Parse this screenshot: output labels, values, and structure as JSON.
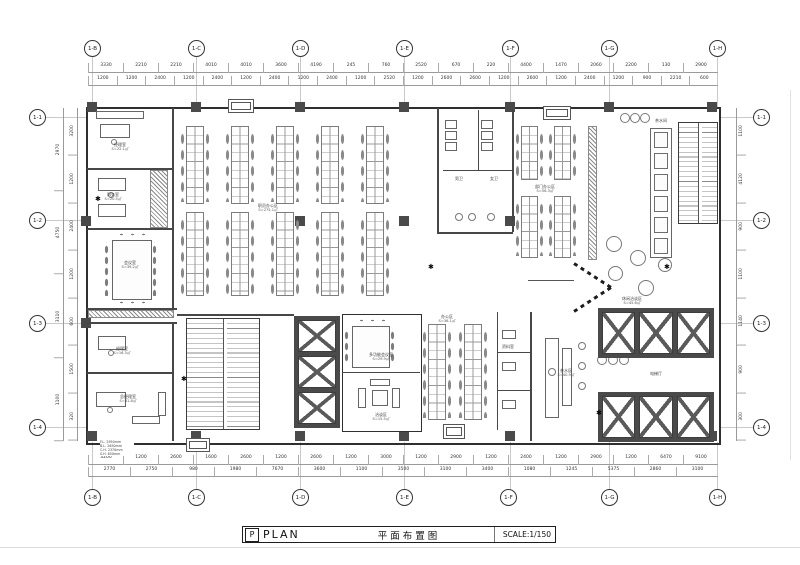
{
  "colors": {
    "wall_poche": "#4a4a4a",
    "line": "#2f2f2f",
    "grid_line": "#c9c9c9",
    "dim_text": "#333333"
  },
  "icons": {
    "plant": "✱"
  },
  "title": {
    "mark": "P",
    "en": "PLAN",
    "cn": "平面布置图",
    "scale": "SCALE:1/150"
  },
  "grid": {
    "top": [
      "1-B",
      "1-C",
      "1-D",
      "1-E",
      "1-F",
      "1-G",
      "1-H"
    ],
    "bottom": [
      "1-B",
      "1-C",
      "1-D",
      "1-E",
      "1-F",
      "1-G",
      "1-H"
    ],
    "left": [
      "1-1",
      "1-2",
      "1-3",
      "1-4"
    ],
    "right": [
      "1-1",
      "1-2",
      "1-3",
      "1-4"
    ]
  },
  "dims": {
    "top1": [
      "3330",
      "2210",
      "2210",
      "4010",
      "4010",
      "3600",
      "4190",
      "245",
      "760",
      "2520",
      "670",
      "220",
      "4400",
      "1470",
      "2060",
      "2200",
      "130",
      "2900"
    ],
    "top2": [
      "1200",
      "1200",
      "2400",
      "1200",
      "2400",
      "1200",
      "2400",
      "1200",
      "2400",
      "1200",
      "2520",
      "1200",
      "2600",
      "2600",
      "1200",
      "2600",
      "1200",
      "2400",
      "1200",
      "900",
      "2210",
      "600"
    ],
    "bottom1": [
      "3200",
      "1200",
      "2600",
      "1600",
      "2600",
      "1200",
      "2600",
      "1200",
      "3000",
      "1200",
      "2900",
      "1200",
      "2400",
      "1200",
      "2900",
      "1200",
      "6470",
      "9100"
    ],
    "bottom2": [
      "2770",
      "2750",
      "980",
      "1980",
      "7670",
      "3600",
      "1100",
      "3500",
      "3100",
      "3400",
      "1080",
      "1245",
      "5375",
      "2860",
      "3100"
    ],
    "left_outer": [
      "2970",
      "4750",
      "3110",
      "1100"
    ],
    "left_inner": [
      "3200",
      "1200",
      "2400",
      "1200",
      "600",
      "1500",
      "320"
    ],
    "right": [
      "1100",
      "4120",
      "900",
      "1100",
      "1140",
      "900",
      "300"
    ]
  },
  "rooms": {
    "office_tl": {
      "label": "经理室",
      "area": "S=22.1㎡"
    },
    "office_tl2": {
      "label": "财务室",
      "area": "S=20.5㎡"
    },
    "conference": {
      "label": "会议室",
      "area": "S=39.2㎡"
    },
    "office_bl": {
      "label": "经理室",
      "area": "S=16.3㎡"
    },
    "office_gm": {
      "label": "总经理室",
      "area": "S=31.8㎡"
    },
    "open_office": {
      "label": "职员办公区",
      "area": "S=275.1㎡"
    },
    "wc_m": {
      "label": "男卫"
    },
    "wc_f": {
      "label": "女卫"
    },
    "pantry_top": {
      "label": "茶水间"
    },
    "lounge": {
      "label": "休闲洽谈区",
      "area": "S=45.6㎡"
    },
    "meeting_mid": {
      "label": "多功能会议室",
      "area": "S=29.9㎡"
    },
    "talk": {
      "label": "洽谈区",
      "area": "S=15.5㎡"
    },
    "lobby": {
      "label": "电梯厅"
    },
    "bar": {
      "label": "茶水区",
      "area": "S=40.9㎡"
    },
    "office_mid": {
      "label": "办公区",
      "area": "S=36.1㎡"
    },
    "office_r": {
      "label": "部门办公区",
      "area": "S=56.3㎡"
    },
    "archive": {
      "label": "资料室"
    }
  },
  "notes": [
    "F.L. 2950mm",
    "B.L. 2650mm",
    "C.H. 2370mm",
    "S.H. 650mm"
  ]
}
